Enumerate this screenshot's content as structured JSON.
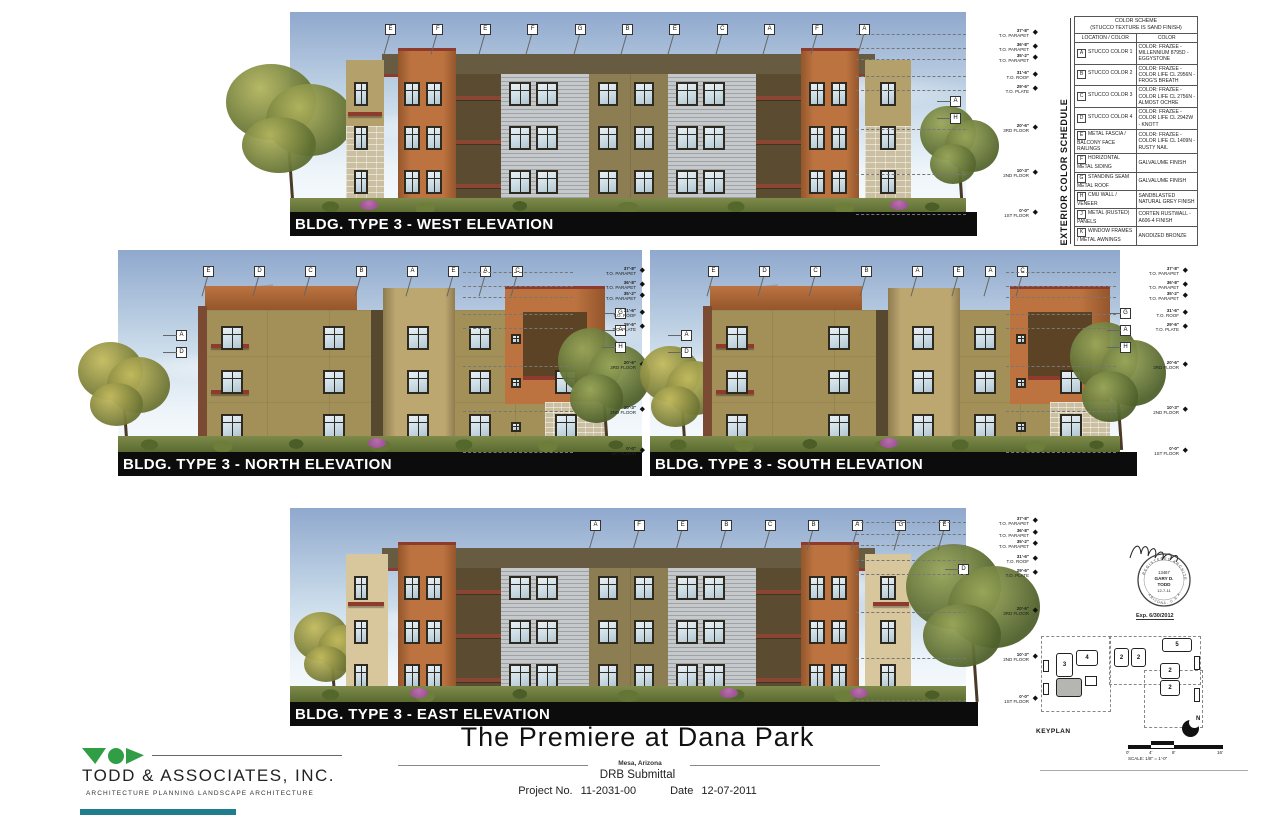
{
  "sheet": {
    "title": "The Premiere at Dana Park",
    "location": "Mesa, Arizona",
    "submittal": "DRB Submittal",
    "project_no_label": "Project No.",
    "project_no": "11-2031-00",
    "date_label": "Date",
    "date": "12-07-2011"
  },
  "firm": {
    "name": "TODD & ASSOCIATES, INC.",
    "tagline": "ARCHITECTURE  PLANNING  LANDSCAPE ARCHITECTURE"
  },
  "elevations": {
    "west": {
      "label": "BLDG. TYPE 3 - WEST ELEVATION",
      "callouts_top": [
        "E",
        "F",
        "E",
        "F",
        "G",
        "B",
        "E",
        "C",
        "A",
        "F",
        "A"
      ],
      "callouts_right": [
        "A",
        "H"
      ]
    },
    "north": {
      "label": "BLDG. TYPE 3 - NORTH ELEVATION",
      "callouts_top1": [
        "E",
        "D",
        "C",
        "B",
        "A"
      ],
      "callouts_top2": [
        "E",
        "A",
        "C"
      ],
      "callouts_left": [
        "A",
        "D"
      ],
      "callouts_right": [
        "G",
        "A",
        "H"
      ]
    },
    "south": {
      "label": "BLDG. TYPE 3 - SOUTH ELEVATION",
      "callouts_top1": [
        "E",
        "D",
        "C",
        "B",
        "A"
      ],
      "callouts_top2": [
        "E",
        "A",
        "C"
      ],
      "callouts_left": [
        "A",
        "D"
      ],
      "callouts_right": [
        "G",
        "A",
        "H"
      ]
    },
    "east": {
      "label": "BLDG. TYPE 3 - EAST ELEVATION",
      "callouts_top": [
        "A",
        "F",
        "E",
        "B",
        "C",
        "B",
        "A",
        "G",
        "E"
      ],
      "callouts_right": [
        "D"
      ]
    }
  },
  "levels": [
    {
      "elev": "37'-8\"",
      "label": "T.O. PARAPET"
    },
    {
      "elev": "36'-8\"",
      "label": "T.O. PARAPET"
    },
    {
      "elev": "35'-2\"",
      "label": "T.O. PARAPET"
    },
    {
      "elev": "31'-6\"",
      "label": "T.O. ROOF"
    },
    {
      "elev": "29'-6\"",
      "label": "T.O. PLATE"
    },
    {
      "elev": "20'-6\"",
      "label": "3RD FLOOR"
    },
    {
      "elev": "10'-3\"",
      "label": "2ND FLOOR"
    },
    {
      "elev": "0'-0\"",
      "label": "1ST FLOOR"
    }
  ],
  "schedule": {
    "vertical_title": "EXTERIOR COLOR SCHEDULE",
    "header_line1": "COLOR SCHEME",
    "header_line2": "(STUCCO TEXTURE IS SAND FINISH)",
    "col1": "LOCATION / COLOR",
    "col2": "COLOR",
    "rows": [
      {
        "key": "A",
        "location": "STUCCO COLOR 1",
        "color": "COLOR: FRAZEE - MILLENNIUM 8795D - EGGYSTONE"
      },
      {
        "key": "B",
        "location": "STUCCO COLOR 2",
        "color": "COLOR: FRAZEE - COLOR LIFE CL 2956N - FROG'S BREATH"
      },
      {
        "key": "C",
        "location": "STUCCO COLOR 3",
        "color": "COLOR: FRAZEE - COLOR LIFE CL 2756N - ALMOST OCHRE"
      },
      {
        "key": "D",
        "location": "STUCCO COLOR 4",
        "color": "COLOR: FRAZEE - COLOR LIFE CL 2942W - KNOTT"
      },
      {
        "key": "E",
        "location": "METAL FASCIA / BALCONY FACE RAILINGS",
        "color": "COLOR: FRAZEE - COLOR LIFE CL 1409N - RUSTY NAIL"
      },
      {
        "key": "F",
        "location": "HORIZONTAL METAL SIDING",
        "color": "GALVALUME FINISH"
      },
      {
        "key": "G",
        "location": "STANDING SEAM METAL ROOF",
        "color": "GALVALUME FINISH"
      },
      {
        "key": "H",
        "location": "CMU WALL / VENEER",
        "color": "SANDBLASTED NATURAL GREY FINISH"
      },
      {
        "key": "J",
        "location": "METAL (RUSTED) PANELS",
        "color": "CORTEN RUSTWALL - A606-4 FINISH"
      },
      {
        "key": "K",
        "location": "WINDOW FRAMES / METAL AWNINGS",
        "color": "ANODIZED BRONZE"
      }
    ]
  },
  "stamp": {
    "number": "13467",
    "name_line1": "GARY D.",
    "name_line2": "TODD",
    "date": "12-7-11",
    "ring_top": "REGISTERED ARCHITECT",
    "ring_bottom": "ARIZONA, U.S.A.",
    "expires": "Exp. 6/30/2012"
  },
  "keyplan": {
    "label": "KEYPLAN",
    "north": "N",
    "buildings": [
      "3",
      "4",
      "2",
      "2",
      "5",
      "2",
      "2"
    ]
  },
  "scalebar": {
    "ticks": [
      "0'",
      "4'",
      "8'",
      "16'"
    ],
    "caption": "SCALE: 1/8\" = 1'-0\""
  },
  "colors": {
    "sky_top": "#8fa8cd",
    "sky_mid": "#c6d8e8",
    "sky_bottom": "#eef5fa",
    "stucco_tan": "#b3a06b",
    "stucco_olive": "#8c7d52",
    "stucco_dark": "#675b41",
    "stucco_cream": "#d8c69c",
    "terracotta": "#bc7340",
    "terracotta_dark": "#94562b",
    "fascia_red": "#8e3a2c",
    "rail_red": "#8a4632",
    "siding_gray": "#b7babd",
    "stone": "#cabfa0",
    "frame_dark": "#2e2a20",
    "glass": "#cfdfe8",
    "recess_dark": "#5a4b31",
    "tree_green": "#5f7034",
    "tree_light": "#9aa75a",
    "trunk": "#4a3a27",
    "shrub_purple": "#a84fa5",
    "bar_black": "#0c0c0c",
    "logo_green": "#2f9e45",
    "teal_bar": "#1f7d8d"
  }
}
